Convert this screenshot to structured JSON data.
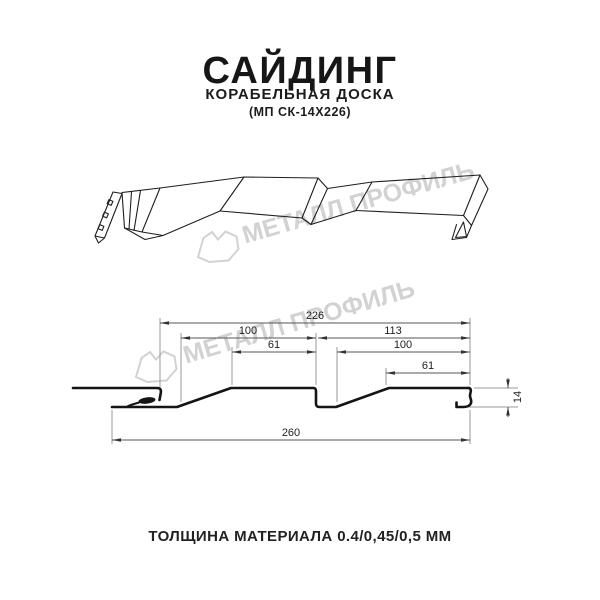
{
  "header": {
    "title": "САЙДИНГ",
    "subtitle": "КОРАБЕЛЬНАЯ ДОСКА",
    "product_code": "(МП СК-14Х226)"
  },
  "watermark": {
    "text": "МЕТАЛЛ ПРОФИЛЬ",
    "color": "#d2d2d2"
  },
  "section_dimensions": {
    "total_top": "226",
    "left_pitch": "100",
    "left_flat": "61",
    "right_span": "113",
    "right_pitch": "100",
    "right_flat": "61",
    "overall_bottom": "260",
    "height": "14"
  },
  "footer": {
    "text": "ТОЛЩИНА МАТЕРИАЛА 0.4/0,45/0,5 ММ"
  },
  "colors": {
    "profile_line": "#141414",
    "dimension_line": "#555555",
    "extension_line": "#999999",
    "watermark": "#d2d2d2"
  }
}
